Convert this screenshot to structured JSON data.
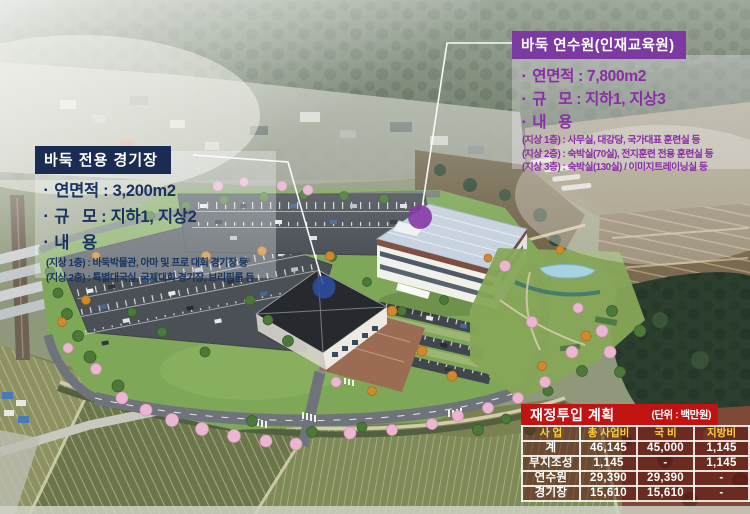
{
  "icons": {
    "bullet": "▪"
  },
  "colors": {
    "stadium_box_navy": "#1b2c52",
    "stadium_text_navy": "#17335f",
    "training_box_purple": "#7c39a2",
    "training_text_purple": "#8b2ca8",
    "table_red": "#c21313",
    "table_header_yellow": "#ffd23c",
    "marker_blue": "#2c4da1",
    "marker_purple": "#8638a6"
  },
  "callouts": {
    "stadium": {
      "title": "바둑 전용 경기장",
      "specs": [
        "연면적 : 3,200m2",
        "규   모 : 지하1, 지상2",
        "내   용"
      ],
      "details": [
        "(지상 1층) : 바둑박물관, 아마 및 프로 대회 경기장 등",
        "(지상 2층) : 특별대국실, 국제대회 경기장, 브리핑룸 등"
      ]
    },
    "training_center": {
      "title": "바둑 연수원(인재교육원)",
      "specs": [
        "연면적 : 7,800m2",
        "규   모 : 지하1, 지상3",
        "내   용"
      ],
      "details": [
        "(지상 1층) : 사무실, 대강당, 국가대표 훈련실 등",
        "(지상 2층) : 숙박실(70실), 전지훈련 전용 훈련실 등",
        "(지상 3층) : 숙박실(130실) / 이미지트레이닝실 등"
      ]
    }
  },
  "budget": {
    "title": "재정투입 계획",
    "unit": "(단위 : 백만원)",
    "columns": [
      "사 업",
      "총 사업비",
      "국 비",
      "지방비"
    ],
    "rows": [
      {
        "name": "계",
        "total": "46,145",
        "national": "45,000",
        "local": "1,145"
      },
      {
        "name": "부지조성",
        "total": "1,145",
        "national": "-",
        "local": "1,145"
      },
      {
        "name": "연수원",
        "total": "29,390",
        "national": "29,390",
        "local": "-"
      },
      {
        "name": "경기장",
        "total": "15,610",
        "national": "15,610",
        "local": "-"
      }
    ]
  }
}
